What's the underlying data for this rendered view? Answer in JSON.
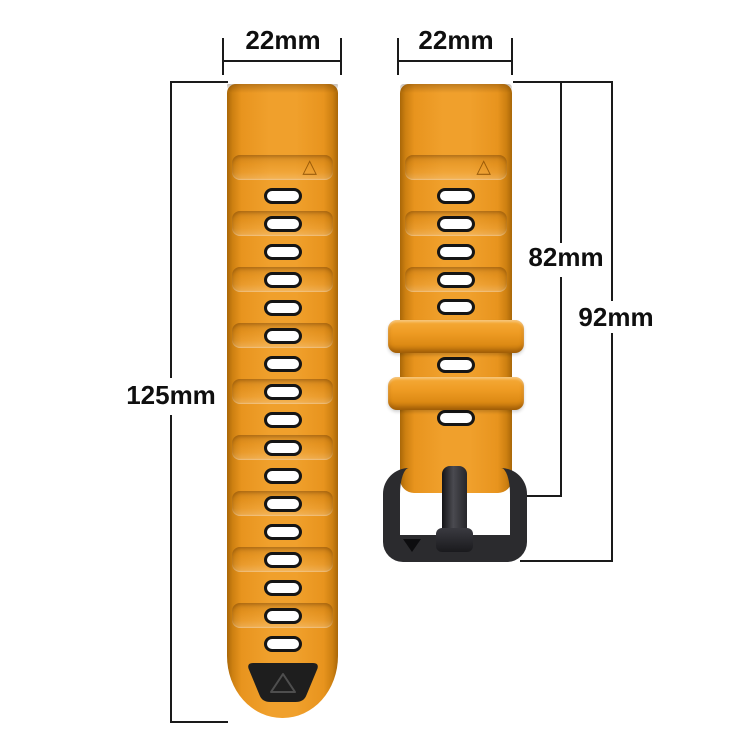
{
  "labels": {
    "left_strap_width": "22mm",
    "right_strap_width": "22mm",
    "left_strap_length": "125mm",
    "right_strap_length_to_buckle": "82mm",
    "right_strap_length_total": "92mm"
  },
  "icons": {
    "triangle_marker": "△",
    "buckle_arrow": "▼"
  },
  "colors": {
    "strap_orange": "#e8941e",
    "strap_orange_light": "#f0a02c",
    "strap_orange_dark": "#a96708",
    "hole_fill": "#ffffff",
    "hole_border": "#151515",
    "tip_black": "#1e1e1e",
    "buckle_black": "#2b2b2e",
    "dimension_line": "#1a1a1a",
    "background": "#ffffff"
  },
  "left_strap": {
    "top": 84,
    "triangle_panel_y": 155,
    "hole_centers_y": [
      196,
      224,
      252,
      280,
      308,
      336,
      364,
      392,
      420,
      448,
      476,
      504,
      532,
      560,
      588,
      616,
      644
    ],
    "panel_hole_indices": [
      1,
      3,
      5,
      7,
      9,
      11,
      13,
      15
    ]
  },
  "right_strap": {
    "top": 84,
    "triangle_panel_y": 155,
    "hole_centers_y": [
      196,
      224,
      252,
      280,
      307,
      365,
      418
    ],
    "panel_hole_indices": [
      1,
      3
    ],
    "keepers_y": [
      320,
      377
    ]
  }
}
